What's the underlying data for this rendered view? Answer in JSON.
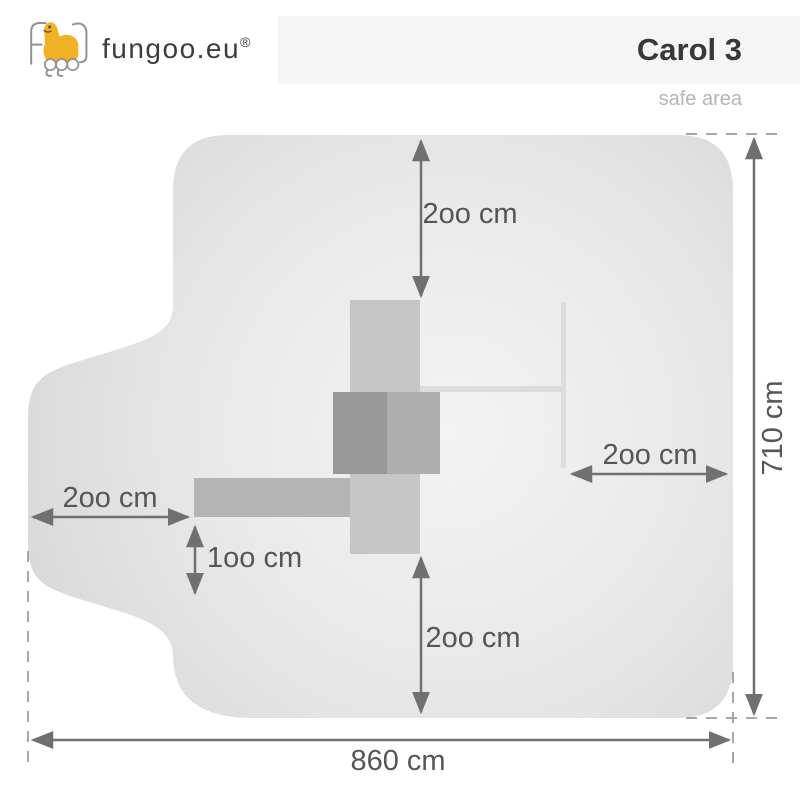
{
  "header": {
    "brand": "fungoo.eu",
    "registered_mark": "®",
    "product_title": "Carol 3",
    "subtitle": "safe area"
  },
  "diagram": {
    "labels": {
      "top_clearance": "2oo cm",
      "bottom_clearance": "2oo cm",
      "left_clearance": "2oo cm",
      "left_offset": "1oo cm",
      "right_clearance": "2oo cm",
      "total_height": "710 cm",
      "total_width": "860 cm"
    },
    "colors": {
      "logo_yellow": "#f0b125",
      "safe_area_fill_edge": "#d6d6d6",
      "safe_area_fill_center": "#f3f3f3",
      "structure_light": "#c6c6c6",
      "structure_medium": "#aeaeae",
      "structure_dark": "#989898",
      "structure_arm": "#b4b4b4",
      "beam_light": "#dcdcdc",
      "arrow_gray": "#707070",
      "dash_gray": "#a6a6a6",
      "dimension_text": "#565656",
      "band_background": "#f5f5f5"
    }
  }
}
